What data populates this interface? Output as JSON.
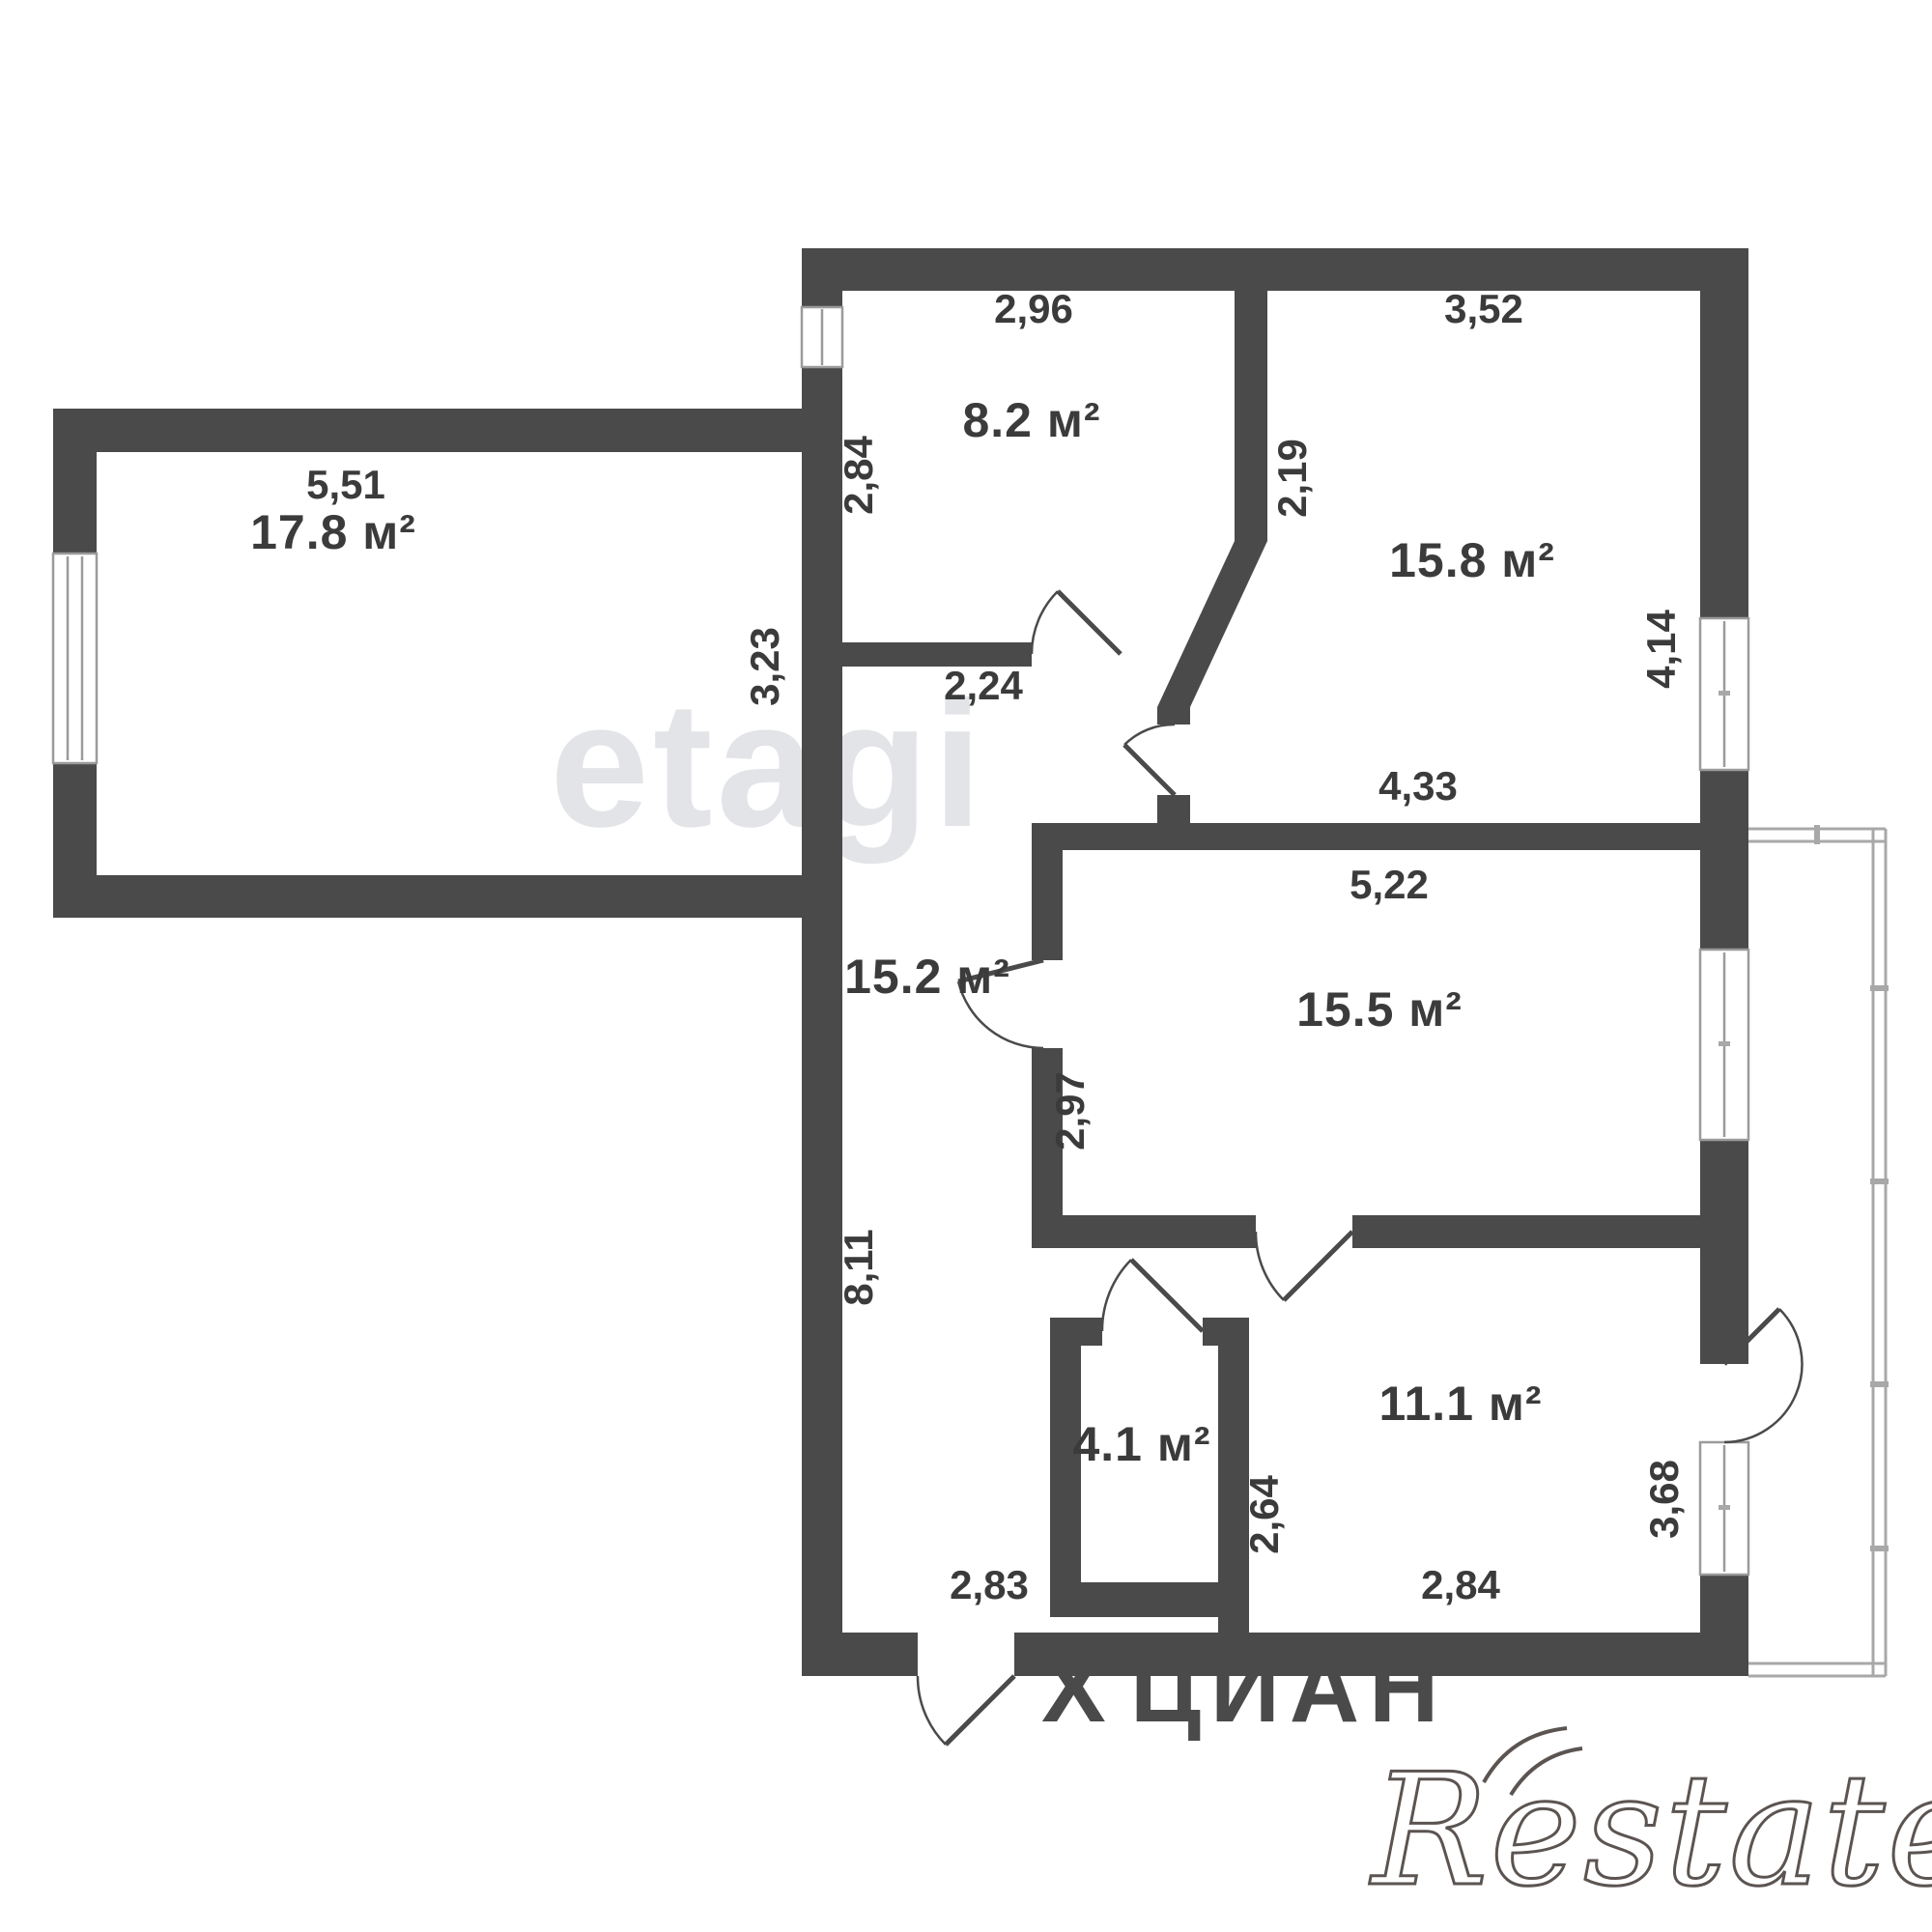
{
  "plan": {
    "type": "apartment-floor-plan",
    "area_unit": "м²",
    "colors": {
      "wall": "#4a4a4b",
      "label_text": "#3b3b3c",
      "window_frame": "#9b9b9b",
      "balcony_rail": "#a8a8a8",
      "watermark_light": "#e3e4e7",
      "watermark_dark": "#4a4a4b",
      "background": "#ffffff"
    },
    "rooms": {
      "r17_8": "17.8 м²",
      "r8_2": "8.2 м²",
      "r15_8": "15.8 м²",
      "r15_2": "15.2 м²",
      "r15_5": "15.5 м²",
      "r4_1": "4.1 м²",
      "r11_1": "11.1 м²"
    },
    "dims": {
      "d5_51": "5,51",
      "d2_96": "2,96",
      "d3_52": "3,52",
      "d2_84_left": "2,84",
      "d2_19": "2,19",
      "d4_14": "4,14",
      "d3_23": "3,23",
      "d2_24": "2,24",
      "d4_33": "4,33",
      "d5_22": "5,22",
      "d2_97": "2,97",
      "d8_11": "8,11",
      "d2_64": "2,64",
      "d2_83": "2,83",
      "d2_84_bottom": "2,84",
      "d3_68": "3,68"
    },
    "watermarks": {
      "center": "etagi",
      "portal_mark": "Х",
      "portal": "ЦИАН",
      "corner": "Restate"
    }
  }
}
